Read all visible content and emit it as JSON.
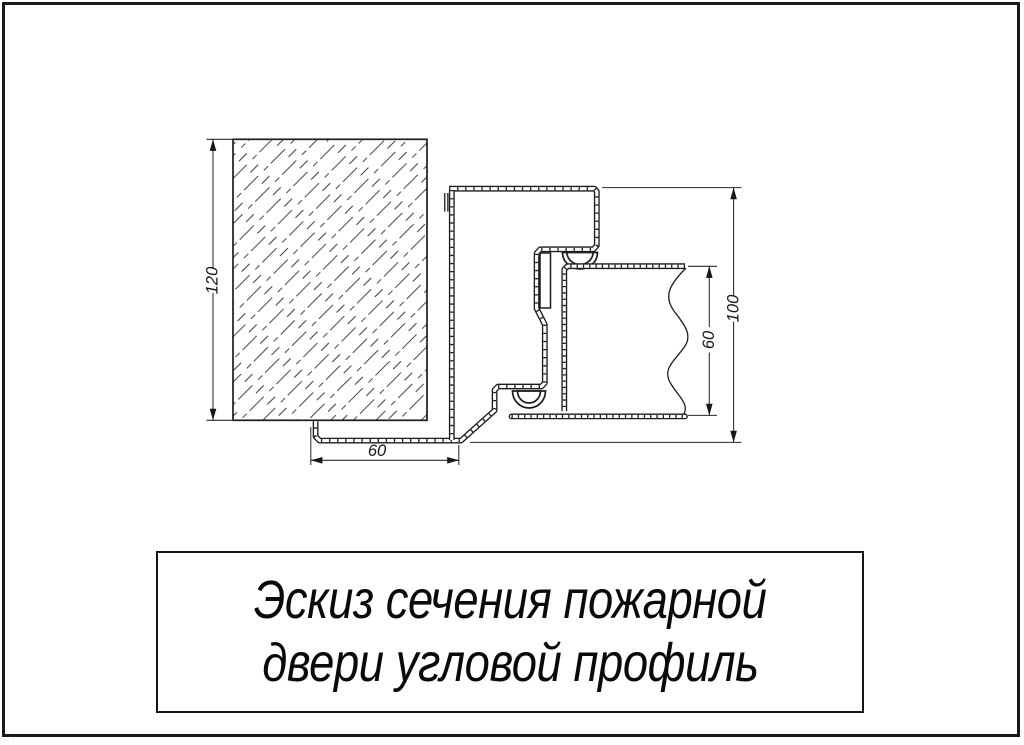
{
  "colors": {
    "line": "#1d1d1d",
    "background": "#ffffff"
  },
  "dimensions": {
    "wall_height": "120",
    "frame_depth": "100",
    "door_leaf_thickness": "60",
    "bottom_flange_width": "60"
  },
  "title_block": {
    "line1": "Эскиз сечения пожарной",
    "line2": "двери угловой профиль"
  }
}
